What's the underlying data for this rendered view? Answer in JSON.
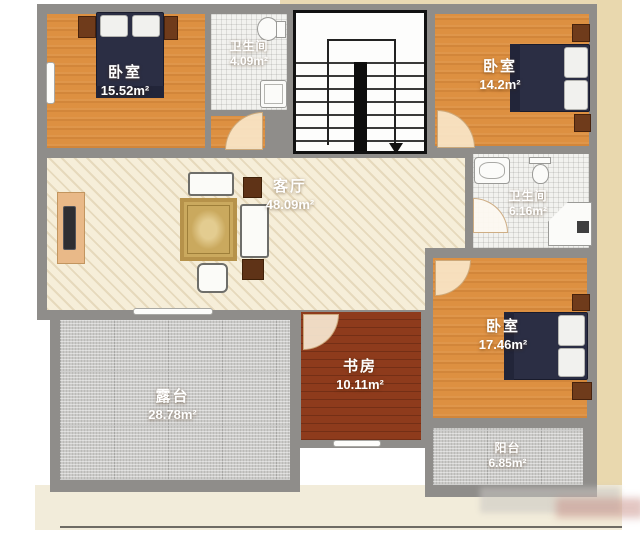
{
  "floor_plan": {
    "rooms": [
      {
        "id": "bedroom-top-left",
        "name": "卧室",
        "area": "15.52m²"
      },
      {
        "id": "bathroom-top",
        "name": "卫生间",
        "area": "4.09m²"
      },
      {
        "id": "bedroom-top-right",
        "name": "卧室",
        "area": "14.2m²"
      },
      {
        "id": "living-room",
        "name": "客厅",
        "area": "48.09m²"
      },
      {
        "id": "bathroom-right",
        "name": "卫生间",
        "area": "6.16m²"
      },
      {
        "id": "bedroom-bottom-right",
        "name": "卧室",
        "area": "17.46m²"
      },
      {
        "id": "study",
        "name": "书房",
        "area": "10.11m²"
      },
      {
        "id": "terrace",
        "name": "露台",
        "area": "28.78m²"
      },
      {
        "id": "balcony",
        "name": "阳台",
        "area": "6.85m²"
      }
    ],
    "stairs": {
      "direction": "down-arrow"
    },
    "colors": {
      "wall": "#8f8d8a",
      "stair_wall": "#111111",
      "wood_floor": "#dd9041",
      "living_floor": "#f6eed9",
      "study_floor": "#8e3b1c",
      "tile_floor": "#f2f2ef",
      "outdoor_floor": "#cbcac8",
      "bed": "#2b2e44",
      "nightstand": "#6f3b1b",
      "door_arc": "#f8e6c8",
      "page_margin": "#f2ecda"
    }
  }
}
